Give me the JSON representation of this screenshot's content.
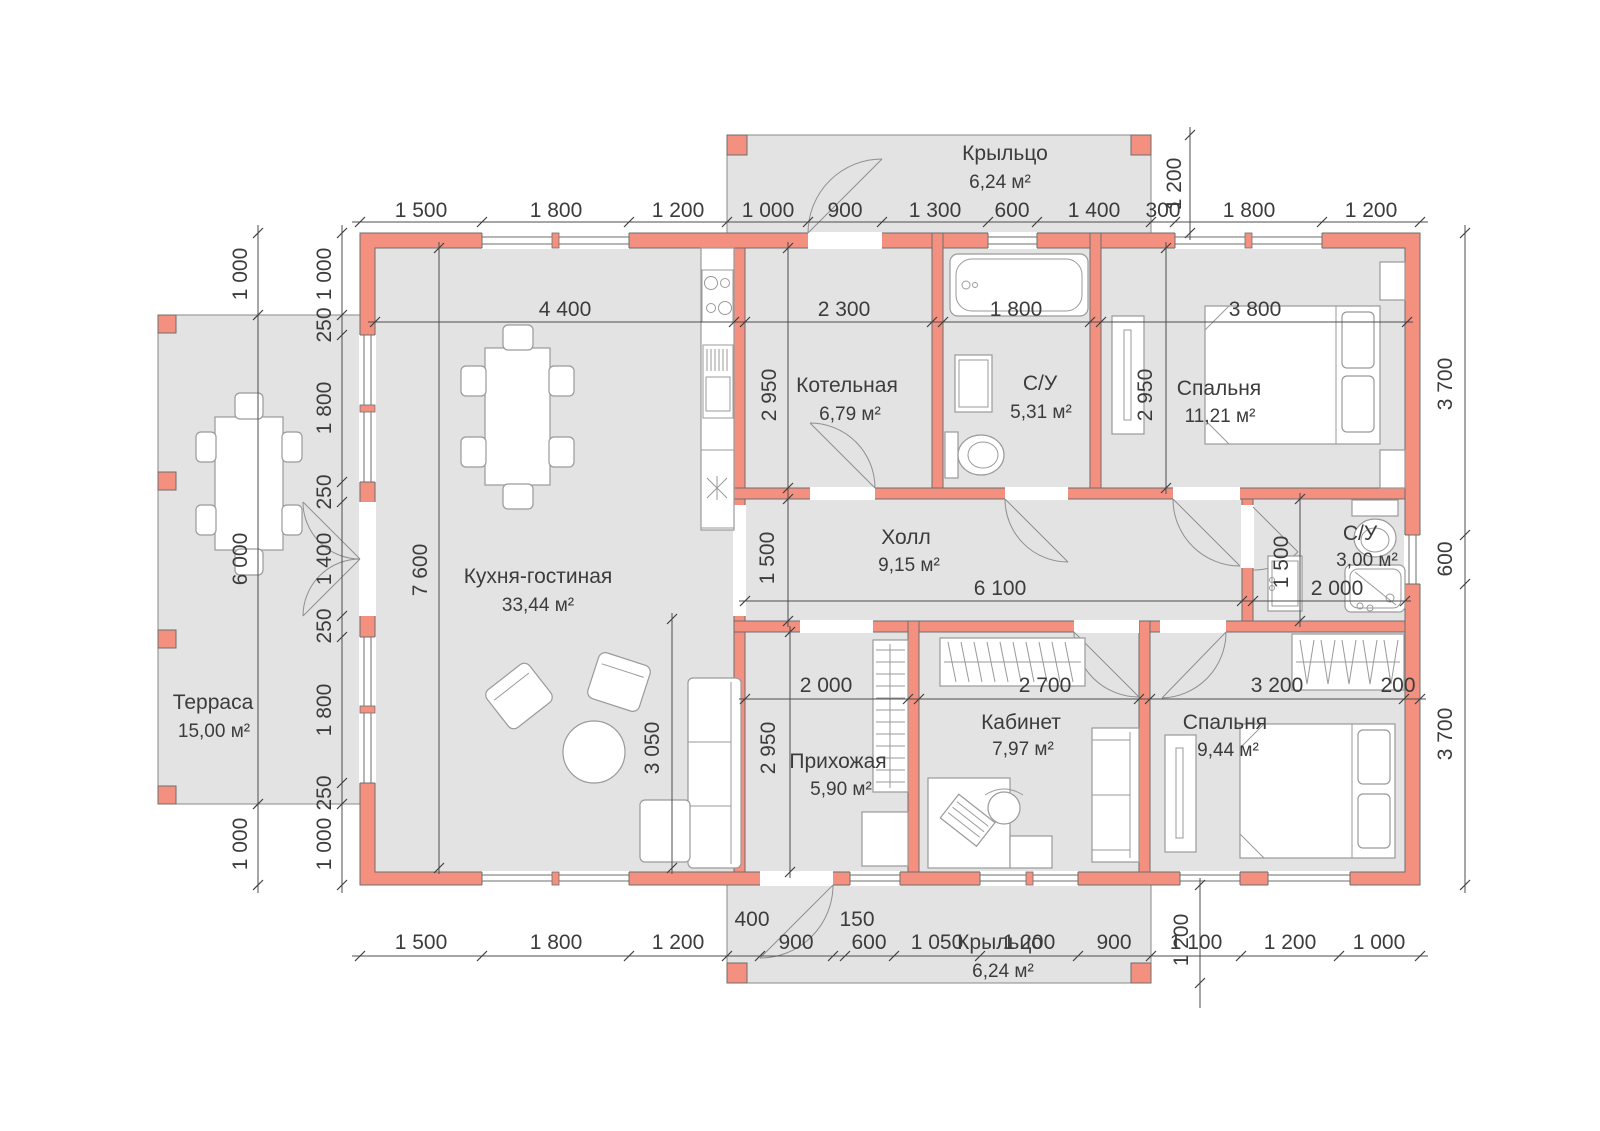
{
  "rooms": [
    {
      "name": "Крыльцо",
      "area": "6,24 м²"
    },
    {
      "name": "Терраса",
      "area": "15,00 м²"
    },
    {
      "name": "Кухня-гостиная",
      "area": "33,44 м²"
    },
    {
      "name": "Котельная",
      "area": "6,79 м²"
    },
    {
      "name": "С/У",
      "area": "5,31 м²"
    },
    {
      "name": "Спальня",
      "area": "11,21 м²"
    },
    {
      "name": "Холл",
      "area": "9,15 м²"
    },
    {
      "name": "С/У",
      "area": "3,00 м²"
    },
    {
      "name": "Прихожая",
      "area": "5,90 м²"
    },
    {
      "name": "Кабинет",
      "area": "7,97 м²"
    },
    {
      "name": "Спальня",
      "area": "9,44 м²"
    },
    {
      "name": "Крыльцо",
      "area": "6,24 м²"
    }
  ],
  "dims": {
    "top": [
      "1 500",
      "1 800",
      "1 200",
      "1 000",
      "900",
      "1 300",
      "600",
      "1 400",
      "300",
      "1 800",
      "1 200"
    ],
    "bottom_main": [
      "1 500",
      "1 800",
      "1 200",
      "900",
      "600",
      "1 050",
      "1 200",
      "900",
      "1 100",
      "1 200",
      "1 000"
    ],
    "bottom_small": [
      "400",
      "150"
    ],
    "left_outer": [
      "1 000",
      "6 000",
      "1 000"
    ],
    "left_inner": [
      "1 000",
      "250",
      "1 800",
      "250",
      "1 400",
      "250",
      "1 800",
      "250",
      "1 000"
    ],
    "right": [
      "3 700",
      "600",
      "3 700"
    ],
    "porch_top_depth": "1 200",
    "porch_bottom_depth": "1 200",
    "interior": {
      "kitchen_w": "4 400",
      "boiler_w": "2 300",
      "bath_w": "1 800",
      "bedroom1_w": "3 800",
      "kitchen_h": "7 600",
      "boiler_h": "2 950",
      "bedroom1_h": "2 950",
      "hall_h": "1 500",
      "hall_w": "6 100",
      "sbath_h": "1 500",
      "sbath_w": "2 000",
      "entry_w": "2 000",
      "office_w": "2 700",
      "bedroom2_w": "3 200",
      "bedroom2_niche": "200",
      "entry_h": "2 950",
      "living_h": "3 050"
    }
  },
  "colors": {
    "wall": "#f4907f",
    "floor": "#e3e3e3",
    "dim_line": "#4c4c4c",
    "text": "#3c3c3c"
  }
}
